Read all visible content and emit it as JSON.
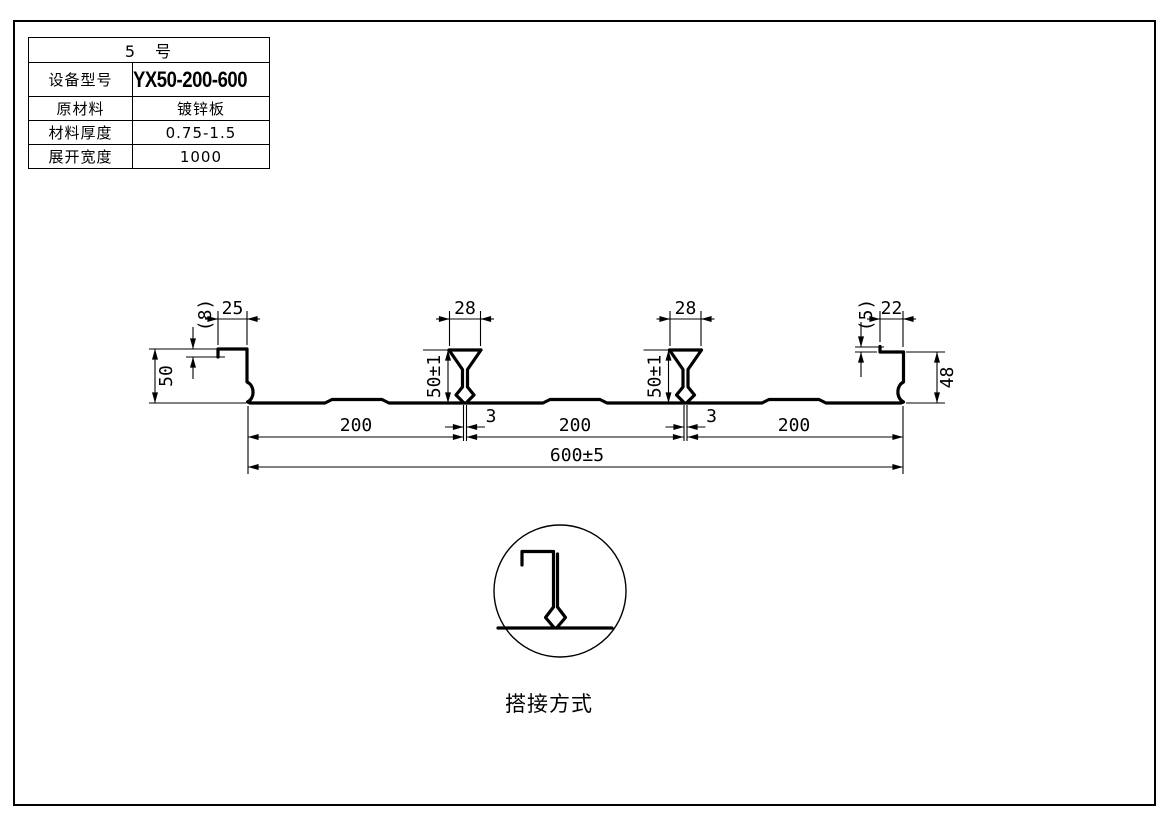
{
  "sheet": {
    "background": "#ffffff",
    "line_color": "#000000"
  },
  "spec_table": {
    "title": "5　号",
    "rows": [
      {
        "label": "设备型号",
        "value": "YX50-200-600"
      },
      {
        "label": "原材料",
        "value": "镀锌板"
      },
      {
        "label": "材料厚度",
        "value": "0.75-1.5"
      },
      {
        "label": "展开宽度",
        "value": "1000"
      }
    ]
  },
  "profile": {
    "left_end": {
      "height": "50",
      "hem": "(8)",
      "lip": "25"
    },
    "ribs": [
      {
        "width": "28",
        "height": "50±1",
        "slot": "3"
      },
      {
        "width": "28",
        "height": "50±1",
        "slot": "3"
      }
    ],
    "right_end": {
      "lip": "22",
      "hem": "(5)",
      "height": "48"
    },
    "spacings": [
      "200",
      "200",
      "200"
    ],
    "overall": "600±5"
  },
  "detail": {
    "caption": "搭接方式"
  }
}
